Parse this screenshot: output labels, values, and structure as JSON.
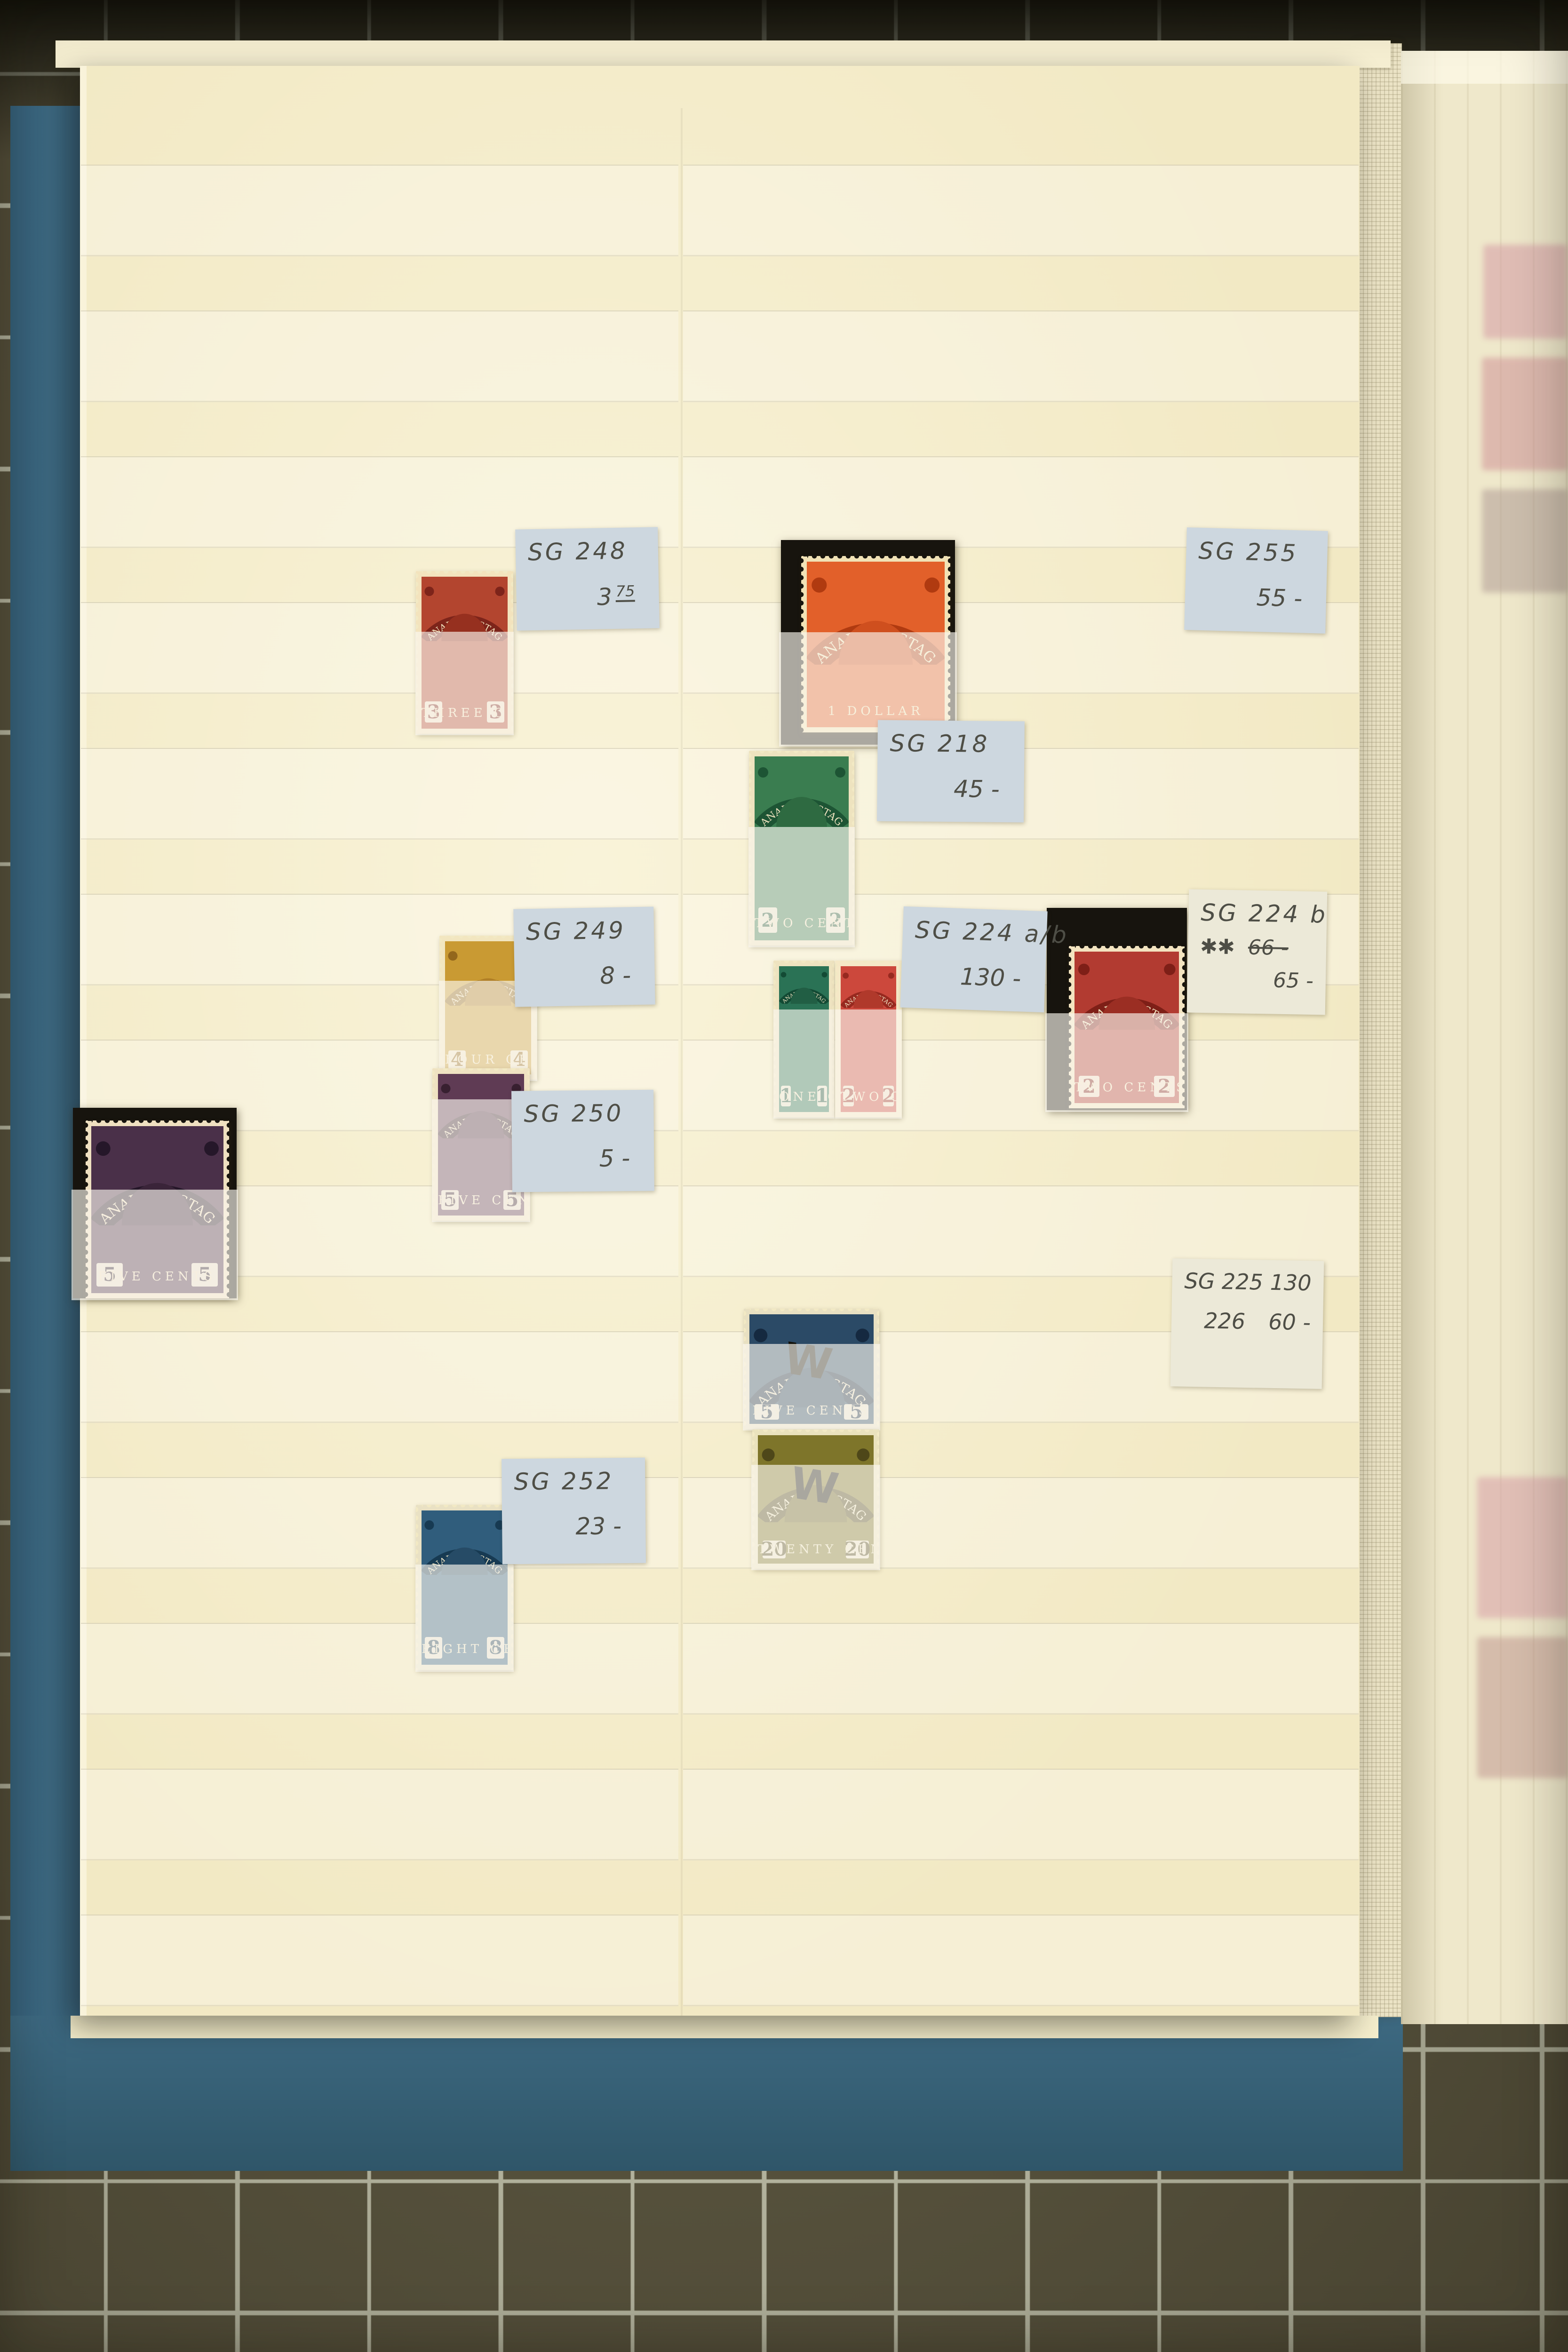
{
  "colors": {
    "mat_base": "#56513c",
    "mat_line": "#b4b49e",
    "cover": "#3d6981",
    "page": "#f2e9c4",
    "page_edge": "#f6efd2",
    "pocket": "rgba(252,250,243,0.38)",
    "glassine": "rgba(250,247,240,0.65)",
    "label_blue": "#cdd7df",
    "label_cream": "#ece9d8",
    "pencil": "#4e4e46",
    "card": "#17140e"
  },
  "labels": {
    "sg248": {
      "code": "SG  248",
      "price": "3",
      "price_sup": "75"
    },
    "sg255": {
      "code": "SG  255",
      "price": "55 -"
    },
    "sg218": {
      "code": "SG  218",
      "price": "45 -"
    },
    "sg249": {
      "code": "SG  249",
      "price": "8 -"
    },
    "sg224ab": {
      "code": "SG 224 a/b",
      "price": "130 -"
    },
    "sg224b": {
      "code": "SG 224 b",
      "stars": "✱✱",
      "old_price": "66 -",
      "price": "65 -"
    },
    "sg250": {
      "code": "SG  250",
      "price": "5 -"
    },
    "sg225_226": {
      "line1_code": "SG 225",
      "line1_price": "130",
      "line2_code": "226",
      "line2_price": "60 -"
    },
    "sg252": {
      "code": "SG  252",
      "price": "23 -"
    }
  },
  "stamps": {
    "s248": {
      "arc": "CANADA POSTAGE",
      "value": "3",
      "bottom": "THREE CENTS",
      "body": "#b3452f",
      "band": "#7d241a",
      "head": "#96301f",
      "paper": "#f3e3bd",
      "fade": 37
    },
    "s255": {
      "arc": "CANADA POSTAGE",
      "value": "",
      "bottom": "1 DOLLAR",
      "body": "#e2602a",
      "band": "#b03a10",
      "head": "#cf4f1e",
      "paper": "#f1e2b6",
      "fade": 45,
      "paper_box": [
        12,
        8,
        85,
        86
      ]
    },
    "s218": {
      "arc": "CANADA POSTAGE",
      "value": "2",
      "bottom": "TWO CENTS",
      "body": "#3a7d50",
      "band": "#1d5434",
      "head": "#2e6a41",
      "paper": "#eee3bf",
      "fade": 39
    },
    "s249": {
      "arc": "CANADA POSTAGE",
      "value": "4",
      "bottom": "FOUR CENTS",
      "body": "#c99a33",
      "band": "#93671c",
      "head": "#b07f27",
      "paper": "#f2e6c0",
      "fade": 31
    },
    "s250": {
      "arc": "CANADA POSTAGE",
      "value": "5",
      "bottom": "FIVE CENTS",
      "body": "#5f3b54",
      "band": "#382030",
      "head": "#4c2d42",
      "paper": "#efe2c2",
      "fade": 20
    },
    "s205v": {
      "arc": "CANADA POSTAGE",
      "value": "5",
      "bottom": "FIVE CENTS",
      "body": "#4a3049",
      "band": "#251729",
      "head": "#3a2439",
      "paper": "#efe0c0",
      "fade": 43,
      "paper_box": [
        8,
        7,
        87,
        93
      ]
    },
    "s224a": {
      "arc": "CANADA POSTAGE",
      "value": "1",
      "bottom": "ONE CENT",
      "body": "#2a7255",
      "band": "#134a34",
      "head": "#215e44",
      "paper": "#eee3c0",
      "fade": 31
    },
    "s224b2": {
      "arc": "CANADA POSTAGE",
      "value": "2",
      "bottom": "TWO CENTS",
      "body": "#cc483c",
      "band": "#97291f",
      "head": "#b0392b",
      "paper": "#f5e8c6",
      "fade": 31
    },
    "s224bc": {
      "arc": "CANADA POSTAGE",
      "value": "2",
      "bottom": "TWO CENTS",
      "body": "#b23b31",
      "band": "#7e1f17",
      "head": "#9b2e23",
      "paper": "#f3e4c0",
      "fade": 52,
      "paper_box": [
        16,
        19,
        82,
        80
      ]
    },
    "s225": {
      "arc": "CANADA POSTAGE",
      "value": "5",
      "bottom": "FIVE CENTS",
      "body": "#2b4a66",
      "band": "#152940",
      "head": "#223c56",
      "paper": "#e8e0c2",
      "fade": 29,
      "mark": "W"
    },
    "s226": {
      "arc": "CANADA POSTAGE",
      "value": "20",
      "bottom": "TWENTY CENTS",
      "body": "#7e752a",
      "band": "#4e4719",
      "head": "#696020",
      "paper": "#eae2bd",
      "fade": 25,
      "mark": "W"
    },
    "s252": {
      "arc": "CANADA POSTAGE",
      "value": "8",
      "bottom": "EIGHT CENTS",
      "body": "#305d7c",
      "band": "#173a52",
      "head": "#264b66",
      "paper": "#e9e1c4",
      "fade": 36
    }
  },
  "ghost_colors": [
    "#d294a0",
    "#cd8b92",
    "#ab9590",
    "#d598a3",
    "#bd918c"
  ]
}
